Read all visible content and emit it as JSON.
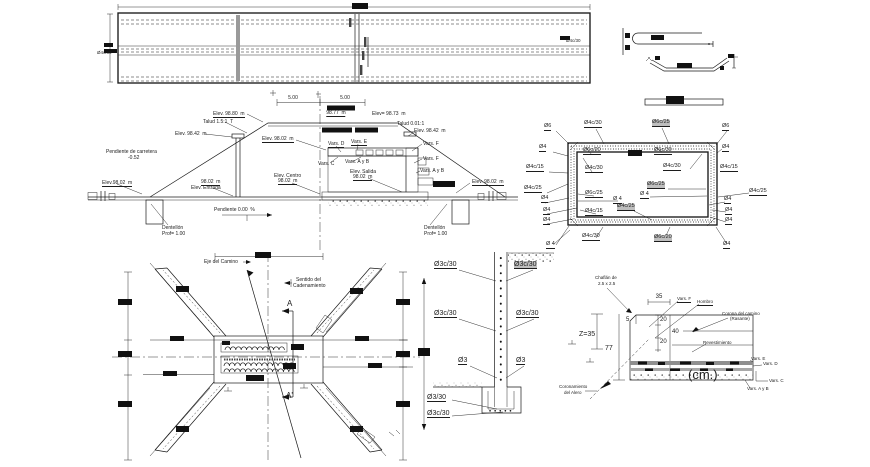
{
  "meta": {
    "drawing_type": "box culvert structural CAD drawing",
    "units_note": "(cm.)",
    "colors": {
      "line": "#1a1a1a",
      "highlight": "#bfbfbf",
      "band_gray": "#9a9a9a"
    }
  },
  "labels": [
    {
      "name": "rebar-spacing-label",
      "t": "Ø4c/30",
      "x": 97,
      "y": 51,
      "fs": 4.5
    },
    {
      "name": "rebar-spacing-label",
      "t": "Ø4c/30",
      "x": 566,
      "y": 39,
      "fs": 4.5
    },
    {
      "name": "dim-label",
      "t": "5.00",
      "x": 293,
      "y": 96,
      "c": 1
    },
    {
      "name": "dim-label",
      "t": "5.00",
      "x": 345,
      "y": 96,
      "c": 1
    },
    {
      "name": "elevation-label",
      "t": "98.77  m",
      "x": 336,
      "y": 111,
      "u": 1,
      "c": 1
    },
    {
      "name": "elevation-label",
      "t": "Elev. 98.80  m",
      "x": 213,
      "y": 112,
      "u": 1
    },
    {
      "name": "elevation-label",
      "t": "Elev= 98.73  m",
      "x": 372,
      "y": 112
    },
    {
      "name": "slope-label",
      "t": "Talud 1.5:1  T",
      "x": 203,
      "y": 120
    },
    {
      "name": "slope-label",
      "t": "Talud 0.01:1",
      "x": 397,
      "y": 122
    },
    {
      "name": "elevation-label",
      "t": "Elev. 98.42  m",
      "x": 175,
      "y": 132
    },
    {
      "name": "elevation-label",
      "t": "Elev. 98.42  m",
      "x": 414,
      "y": 129
    },
    {
      "name": "elevation-label",
      "t": "Elev. 98.02  m",
      "x": 262,
      "y": 137,
      "u": 1
    },
    {
      "name": "varilla-label",
      "t": "Vars. D",
      "x": 328,
      "y": 142,
      "u": 1
    },
    {
      "name": "varilla-label",
      "t": "Vars. E",
      "x": 351,
      "y": 140,
      "u": 1
    },
    {
      "name": "varilla-label",
      "t": "Vars. C",
      "x": 318,
      "y": 162
    },
    {
      "name": "varilla-label",
      "t": "Vars. A y B",
      "x": 345,
      "y": 160
    },
    {
      "name": "varilla-label",
      "t": "Vars. F",
      "x": 423,
      "y": 142
    },
    {
      "name": "varilla-label",
      "t": "Vars. F",
      "x": 423,
      "y": 157
    },
    {
      "name": "varilla-label",
      "t": "Vars. A y B",
      "x": 420,
      "y": 169
    },
    {
      "name": "slope-note",
      "t": "Pendiente de carretera",
      "x": 106,
      "y": 150
    },
    {
      "name": "slope-note",
      "t": "-0.52",
      "x": 128,
      "y": 156
    },
    {
      "name": "elevation-label",
      "t": "Elev. Centro",
      "x": 274,
      "y": 174
    },
    {
      "name": "elevation-label",
      "t": "98.02  m",
      "x": 278,
      "y": 179,
      "u": 1
    },
    {
      "name": "elevation-label",
      "t": "Elev. Salida",
      "x": 350,
      "y": 170
    },
    {
      "name": "elevation-label",
      "t": "98.02  m",
      "x": 353,
      "y": 175,
      "u": 1
    },
    {
      "name": "elevation-label",
      "t": "98.02  m",
      "x": 201,
      "y": 180,
      "u": 1
    },
    {
      "name": "elevation-label",
      "t": "Elev. Entrada",
      "x": 191,
      "y": 186
    },
    {
      "name": "elevation-label",
      "t": "Elev.98.02  m",
      "x": 102,
      "y": 181,
      "u": 1
    },
    {
      "name": "elevation-label",
      "t": "Elev. 98.02  m",
      "x": 472,
      "y": 180,
      "u": 1
    },
    {
      "name": "slope-note",
      "t": "Pendiente 0.00  %",
      "x": 214,
      "y": 208
    },
    {
      "name": "toe-wall-label",
      "t": "Dentellón",
      "x": 162,
      "y": 226
    },
    {
      "name": "toe-wall-label",
      "t": "Prof= 1.00",
      "x": 162,
      "y": 232
    },
    {
      "name": "toe-wall-label",
      "t": "Dentellón",
      "x": 424,
      "y": 226
    },
    {
      "name": "toe-wall-label",
      "t": "Prof= 1.00",
      "x": 424,
      "y": 232
    },
    {
      "name": "rebar-diameter-label",
      "t": "Ø6",
      "x": 544,
      "y": 124,
      "u": 1,
      "fs": 5.5
    },
    {
      "name": "rebar-spacing-label",
      "t": "Ø4c/30",
      "x": 584,
      "y": 121,
      "u": 1,
      "fs": 5.5
    },
    {
      "name": "rebar-spacing-label",
      "t": "Ø6c/25",
      "x": 652,
      "y": 120,
      "u": 1,
      "hl": 1,
      "fs": 5.5
    },
    {
      "name": "rebar-diameter-label",
      "t": "Ø6",
      "x": 722,
      "y": 124,
      "u": 1,
      "fs": 5.5
    },
    {
      "name": "rebar-diameter-label",
      "t": "Ø4",
      "x": 539,
      "y": 145,
      "u": 1,
      "fs": 5.5
    },
    {
      "name": "rebar-spacing-label",
      "t": "Ø6c/20",
      "x": 583,
      "y": 148,
      "u": 1,
      "fs": 5.5
    },
    {
      "name": "rebar-spacing-label",
      "t": "Ø6c/30",
      "x": 654,
      "y": 148,
      "u": 1,
      "fs": 5.5
    },
    {
      "name": "rebar-diameter-label",
      "t": "Ø4",
      "x": 722,
      "y": 145,
      "u": 1,
      "fs": 5.5
    },
    {
      "name": "rebar-spacing-label",
      "t": "Ø4c/15",
      "x": 526,
      "y": 165,
      "u": 1,
      "fs": 5.5
    },
    {
      "name": "rebar-spacing-label",
      "t": "Ø4c/30",
      "x": 585,
      "y": 166,
      "u": 1,
      "fs": 5.5
    },
    {
      "name": "rebar-spacing-label",
      "t": "Ø4c/30",
      "x": 663,
      "y": 164,
      "u": 1,
      "fs": 5.5
    },
    {
      "name": "rebar-spacing-label",
      "t": "Ø4c/15",
      "x": 720,
      "y": 165,
      "u": 1,
      "fs": 5.5
    },
    {
      "name": "rebar-spacing-label",
      "t": "Ø4c/25",
      "x": 524,
      "y": 186,
      "u": 1,
      "fs": 5.5
    },
    {
      "name": "rebar-spacing-label",
      "t": "Ø6c/25",
      "x": 585,
      "y": 191,
      "u": 1,
      "fs": 5.5
    },
    {
      "name": "rebar-spacing-label",
      "t": "Ø6c/25",
      "x": 647,
      "y": 182,
      "u": 1,
      "hl": 1,
      "fs": 5.5
    },
    {
      "name": "rebar-diameter-label",
      "t": "Ø 4",
      "x": 613,
      "y": 197,
      "u": 1,
      "fs": 5.5
    },
    {
      "name": "rebar-diameter-label",
      "t": "Ø 4",
      "x": 640,
      "y": 192,
      "u": 1,
      "fs": 5.5
    },
    {
      "name": "rebar-spacing-label",
      "t": "Ø4c/25",
      "x": 749,
      "y": 189,
      "u": 1,
      "fs": 5.5
    },
    {
      "name": "rebar-diameter-label",
      "t": "Ø4",
      "x": 541,
      "y": 196,
      "u": 1,
      "fs": 5.5
    },
    {
      "name": "rebar-diameter-label",
      "t": "Ø4",
      "x": 543,
      "y": 208,
      "u": 1,
      "fs": 5.5
    },
    {
      "name": "rebar-diameter-label",
      "t": "Ø4",
      "x": 543,
      "y": 218,
      "u": 1,
      "fs": 5.5
    },
    {
      "name": "rebar-spacing-label",
      "t": "Ø4c/15",
      "x": 585,
      "y": 209,
      "u": 1,
      "fs": 5.5
    },
    {
      "name": "rebar-spacing-label",
      "t": "Ø4c/25",
      "x": 617,
      "y": 204,
      "u": 1,
      "hl": 1,
      "fs": 5.5
    },
    {
      "name": "rebar-diameter-label",
      "t": "Ø4",
      "x": 724,
      "y": 197,
      "u": 1,
      "fs": 5.5
    },
    {
      "name": "rebar-diameter-label",
      "t": "Ø4",
      "x": 725,
      "y": 208,
      "u": 1,
      "fs": 5.5
    },
    {
      "name": "rebar-diameter-label",
      "t": "Ø4",
      "x": 725,
      "y": 218,
      "u": 1,
      "fs": 5.5
    },
    {
      "name": "rebar-spacing-label",
      "t": "Ø4c/30",
      "x": 582,
      "y": 234,
      "u": 1,
      "fs": 5.5
    },
    {
      "name": "rebar-spacing-label",
      "t": "Ø6c/20",
      "x": 654,
      "y": 235,
      "u": 1,
      "hl": 1,
      "fs": 5.5
    },
    {
      "name": "rebar-diameter-label",
      "t": "Ø 4",
      "x": 546,
      "y": 242,
      "u": 1,
      "fs": 5.5
    },
    {
      "name": "rebar-diameter-label",
      "t": "Ø4",
      "x": 723,
      "y": 242,
      "u": 1,
      "fs": 5.5
    },
    {
      "name": "axis-label",
      "t": "Eje del Camino",
      "x": 204,
      "y": 260
    },
    {
      "name": "axis-label",
      "t": "Sentido del",
      "x": 296,
      "y": 278
    },
    {
      "name": "axis-label",
      "t": "Cadenamiento",
      "x": 293,
      "y": 284
    },
    {
      "name": "section-marker",
      "t": "A",
      "x": 287,
      "y": 300,
      "fs": 8
    },
    {
      "name": "section-marker",
      "t": "A'",
      "x": 286,
      "y": 392,
      "fs": 8
    },
    {
      "name": "rebar-spacing-label",
      "t": "Ø3c/30",
      "x": 434,
      "y": 261,
      "u": 1,
      "fs": 7
    },
    {
      "name": "rebar-spacing-label",
      "t": "Ø3c/30",
      "x": 514,
      "y": 261,
      "u": 1,
      "hl": 1,
      "fs": 7
    },
    {
      "name": "rebar-spacing-label",
      "t": "Ø3c/30",
      "x": 434,
      "y": 310,
      "u": 1,
      "fs": 7
    },
    {
      "name": "rebar-spacing-label",
      "t": "Ø3c/30",
      "x": 516,
      "y": 310,
      "u": 1,
      "fs": 7
    },
    {
      "name": "rebar-diameter-label",
      "t": "Ø3",
      "x": 458,
      "y": 357,
      "u": 1,
      "fs": 7
    },
    {
      "name": "rebar-diameter-label",
      "t": "Ø3",
      "x": 516,
      "y": 357,
      "u": 1,
      "fs": 7
    },
    {
      "name": "rebar-spacing-label",
      "t": "Ø3/30",
      "x": 427,
      "y": 394,
      "u": 1,
      "fs": 7
    },
    {
      "name": "rebar-spacing-label",
      "t": "Ø3c/30",
      "x": 427,
      "y": 410,
      "u": 1,
      "fs": 7
    },
    {
      "name": "chamfer-note",
      "t": "Chaflán de",
      "x": 595,
      "y": 276,
      "fs": 4.5
    },
    {
      "name": "chamfer-note",
      "t": "2.5 x 2.5",
      "x": 598,
      "y": 282,
      "fs": 4.5
    },
    {
      "name": "dim-label",
      "t": "35",
      "x": 659,
      "y": 294,
      "fs": 6,
      "c": 1
    },
    {
      "name": "dim-label",
      "t": "Z=35",
      "x": 579,
      "y": 331,
      "fs": 7
    },
    {
      "name": "dim-label",
      "t": "5",
      "x": 626,
      "y": 317,
      "fs": 6
    },
    {
      "name": "dim-label",
      "t": "20",
      "x": 660,
      "y": 317,
      "fs": 6
    },
    {
      "name": "dim-label",
      "t": "40",
      "x": 672,
      "y": 329,
      "fs": 6
    },
    {
      "name": "dim-label",
      "t": "20",
      "x": 660,
      "y": 339,
      "fs": 6
    },
    {
      "name": "dim-label",
      "t": "77",
      "x": 605,
      "y": 345,
      "fs": 7
    },
    {
      "name": "varilla-label",
      "t": "Vars. F",
      "x": 677,
      "y": 297,
      "u": 1,
      "fs": 4.5
    },
    {
      "name": "road-part-label",
      "t": "Hombro",
      "x": 697,
      "y": 300,
      "u": 1,
      "fs": 4.5
    },
    {
      "name": "road-part-label",
      "t": "Corona del camino",
      "x": 722,
      "y": 312,
      "fs": 4.5
    },
    {
      "name": "road-part-label",
      "t": "(Rasante)",
      "x": 730,
      "y": 317,
      "fs": 4.5
    },
    {
      "name": "road-part-label",
      "t": "Revestimiento",
      "x": 703,
      "y": 341,
      "fs": 4.5
    },
    {
      "name": "varilla-label",
      "t": "Vars. E",
      "x": 751,
      "y": 357,
      "fs": 4.5
    },
    {
      "name": "varilla-label",
      "t": "Vars. D",
      "x": 763,
      "y": 362,
      "fs": 4.5
    },
    {
      "name": "varilla-label",
      "t": "Vars. C",
      "x": 769,
      "y": 379,
      "fs": 4.5
    },
    {
      "name": "varilla-label",
      "t": "Vars. A y B",
      "x": 747,
      "y": 387,
      "fs": 4.5
    },
    {
      "name": "units-label",
      "t": "(cm.)",
      "x": 688,
      "y": 368,
      "fs": 13
    },
    {
      "name": "wingwall-note",
      "t": "Coronamiento",
      "x": 559,
      "y": 385,
      "fs": 4.5
    },
    {
      "name": "wingwall-note",
      "t": "del Alero",
      "x": 564,
      "y": 391,
      "fs": 4.5
    }
  ]
}
